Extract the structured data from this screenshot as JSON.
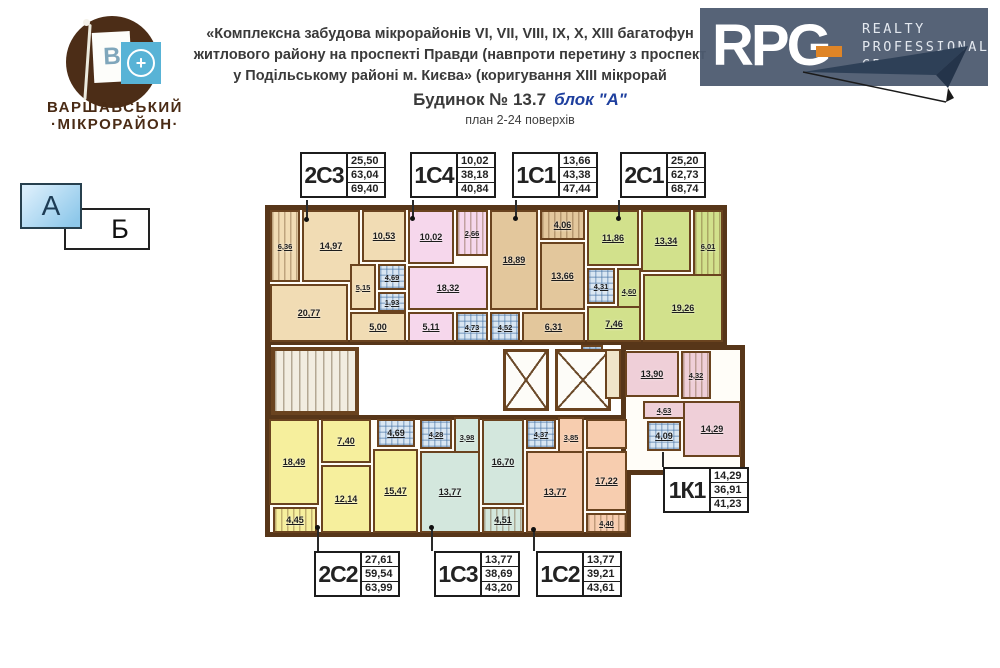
{
  "branding": {
    "microdistrict": {
      "flag_letter": "В",
      "plus": "+",
      "line1": "ВАРШАВСЬКИЙ",
      "line2": "·МІКРОРАЙОН·"
    },
    "rpg": {
      "acronym": "RPG",
      "word1": "REALTY",
      "word2": "PROFESSIONAL",
      "word3": "GROUP",
      "bg": "#4d5b70",
      "accent": "#df8527"
    }
  },
  "title": {
    "line1": "«Комплексна забудова мікрорайонів VI, VII, VIII, IX, X, XIII багатофун",
    "line2": "житлового району на проспекті Правди (навпроти перетину з проспект",
    "line3": "у Подільському районі м. Києва» (коригування XIII мікрорай",
    "building": "Будинок № 13.7",
    "block": "блок \"А\"",
    "block_color": "#1e3f9e",
    "plan_note": "план 2-24 поверхів"
  },
  "block_selector": {
    "a": "А",
    "b": "Б"
  },
  "apartment_labels": [
    {
      "code": "2С3",
      "values": [
        "25,50",
        "63,04",
        "69,40"
      ],
      "x": 300,
      "y": 152
    },
    {
      "code": "1С4",
      "values": [
        "10,02",
        "38,18",
        "40,84"
      ],
      "x": 410,
      "y": 152
    },
    {
      "code": "1С1",
      "values": [
        "13,66",
        "43,38",
        "47,44"
      ],
      "x": 512,
      "y": 152
    },
    {
      "code": "2С1",
      "values": [
        "25,20",
        "62,73",
        "68,74"
      ],
      "x": 620,
      "y": 152
    },
    {
      "code": "2С2",
      "values": [
        "27,61",
        "59,54",
        "63,99"
      ],
      "x": 314,
      "y": 551
    },
    {
      "code": "1С3",
      "values": [
        "13,77",
        "38,69",
        "43,20"
      ],
      "x": 434,
      "y": 551
    },
    {
      "code": "1С2",
      "values": [
        "13,77",
        "39,21",
        "43,61"
      ],
      "x": 536,
      "y": 551
    },
    {
      "code": "1К1",
      "values": [
        "14,29",
        "36,91",
        "41,23"
      ],
      "x": 663,
      "y": 467
    }
  ],
  "leader_lines": [
    {
      "x": 306,
      "y": 200,
      "h": 20,
      "dot": "bottom"
    },
    {
      "x": 412,
      "y": 200,
      "h": 19,
      "dot": "bottom"
    },
    {
      "x": 515,
      "y": 200,
      "h": 19,
      "dot": "bottom"
    },
    {
      "x": 618,
      "y": 200,
      "h": 19,
      "dot": "bottom"
    },
    {
      "x": 317,
      "y": 527,
      "h": 24,
      "dot": "top"
    },
    {
      "x": 431,
      "y": 527,
      "h": 24,
      "dot": "top"
    },
    {
      "x": 533,
      "y": 529,
      "h": 22,
      "dot": "top"
    },
    {
      "x": 662,
      "y": 452,
      "h": 15,
      "dot": "none"
    }
  ],
  "plan": {
    "wall_color": "#573619",
    "apt_colors": {
      "2С3": "#f1dcb4",
      "1С4": "#f6d7ec",
      "1С1": "#e3c79c",
      "2С1": "#d2e18c",
      "1К1": "#efcfd8",
      "2С2": "#f6ef9d",
      "1С3": "#d3e7dd",
      "1С2": "#f7cdaf",
      "util": "#f0e4c9"
    },
    "blocks": [
      {
        "x": 2,
        "y": 2,
        "w": 462,
        "h": 140
      },
      {
        "x": 2,
        "y": 212,
        "w": 366,
        "h": 122
      },
      {
        "x": 358,
        "y": 142,
        "w": 124,
        "h": 130
      }
    ],
    "walls": [
      {
        "x": 2,
        "y": 142,
        "w": 6,
        "h": 72
      }
    ],
    "rooms": [
      {
        "apt": "2С3",
        "a": "6,36",
        "x": 7,
        "y": 7,
        "w": 30,
        "h": 72,
        "p": "s"
      },
      {
        "apt": "2С3",
        "a": "14,97",
        "x": 39,
        "y": 7,
        "w": 58,
        "h": 72
      },
      {
        "apt": "2С3",
        "a": "10,53",
        "x": 99,
        "y": 7,
        "w": 44,
        "h": 52
      },
      {
        "apt": "2С3",
        "a": "20,77",
        "x": 7,
        "y": 81,
        "w": 78,
        "h": 58
      },
      {
        "apt": "2С3",
        "a": "5,15",
        "x": 87,
        "y": 61,
        "w": 26,
        "h": 46
      },
      {
        "apt": "2С3",
        "a": "4,69",
        "x": 115,
        "y": 61,
        "w": 28,
        "h": 26,
        "p": "b"
      },
      {
        "apt": "2С3",
        "a": "1,93",
        "x": 115,
        "y": 89,
        "w": 28,
        "h": 20,
        "p": "b"
      },
      {
        "apt": "2С3",
        "a": "5,00",
        "x": 87,
        "y": 109,
        "w": 56,
        "h": 30
      },
      {
        "apt": "1С4",
        "a": "10,02",
        "x": 145,
        "y": 7,
        "w": 46,
        "h": 54
      },
      {
        "apt": "1С4",
        "a": "2,66",
        "x": 193,
        "y": 7,
        "w": 32,
        "h": 46,
        "p": "s"
      },
      {
        "apt": "1С4",
        "a": "18,32",
        "x": 145,
        "y": 63,
        "w": 80,
        "h": 44
      },
      {
        "apt": "1С4",
        "a": "5,11",
        "x": 145,
        "y": 109,
        "w": 46,
        "h": 30
      },
      {
        "apt": "1С4",
        "a": "4,73",
        "x": 193,
        "y": 109,
        "w": 32,
        "h": 30,
        "p": "b"
      },
      {
        "apt": "1С1",
        "a": "18,89",
        "x": 227,
        "y": 7,
        "w": 48,
        "h": 100
      },
      {
        "apt": "1С1",
        "a": "4,06",
        "x": 277,
        "y": 7,
        "w": 45,
        "h": 30,
        "p": "s"
      },
      {
        "apt": "1С1",
        "a": "13,66",
        "x": 277,
        "y": 39,
        "w": 45,
        "h": 68
      },
      {
        "apt": "1С1",
        "a": "4,52",
        "x": 227,
        "y": 109,
        "w": 30,
        "h": 30,
        "p": "b"
      },
      {
        "apt": "1С1",
        "a": "6,31",
        "x": 259,
        "y": 109,
        "w": 63,
        "h": 30
      },
      {
        "apt": "2С1",
        "a": "11,86",
        "x": 324,
        "y": 7,
        "w": 52,
        "h": 56
      },
      {
        "apt": "2С1",
        "a": "13,34",
        "x": 378,
        "y": 7,
        "w": 50,
        "h": 62
      },
      {
        "apt": "2С1",
        "a": "6,01",
        "x": 430,
        "y": 7,
        "w": 30,
        "h": 72,
        "p": "s"
      },
      {
        "apt": "2С1",
        "a": "4,31",
        "x": 324,
        "y": 65,
        "w": 28,
        "h": 36,
        "p": "b"
      },
      {
        "apt": "2С1",
        "a": "4,60",
        "x": 354,
        "y": 65,
        "w": 24,
        "h": 46
      },
      {
        "apt": "2С1",
        "a": "7,46",
        "x": 324,
        "y": 103,
        "w": 54,
        "h": 36
      },
      {
        "apt": "2С1",
        "a": "19,26",
        "x": 380,
        "y": 71,
        "w": 80,
        "h": 68
      },
      {
        "apt": "2С1",
        "a": "1,90",
        "x": 318,
        "y": 142,
        "w": 22,
        "h": 18,
        "p": "b"
      },
      {
        "apt": "stair",
        "a": "",
        "x": 8,
        "y": 144,
        "w": 88,
        "h": 68,
        "p": "t"
      },
      {
        "apt": "lift",
        "a": "",
        "x": 240,
        "y": 146,
        "w": 46,
        "h": 62,
        "p": "e"
      },
      {
        "apt": "lift",
        "a": "",
        "x": 292,
        "y": 146,
        "w": 56,
        "h": 62,
        "p": "e"
      },
      {
        "apt": "util",
        "a": "",
        "x": 342,
        "y": 146,
        "w": 16,
        "h": 50
      },
      {
        "apt": "1К1",
        "a": "13,90",
        "x": 362,
        "y": 148,
        "w": 54,
        "h": 46
      },
      {
        "apt": "1К1",
        "a": "4,32",
        "x": 418,
        "y": 148,
        "w": 30,
        "h": 48,
        "p": "s"
      },
      {
        "apt": "1К1",
        "a": "4,63",
        "x": 380,
        "y": 198,
        "w": 42,
        "h": 18
      },
      {
        "apt": "1К1",
        "a": "4,09",
        "x": 384,
        "y": 218,
        "w": 34,
        "h": 30,
        "p": "b"
      },
      {
        "apt": "1К1",
        "a": "14,29",
        "x": 420,
        "y": 198,
        "w": 58,
        "h": 56
      },
      {
        "apt": "2С2",
        "a": "18,49",
        "x": 6,
        "y": 216,
        "w": 50,
        "h": 86
      },
      {
        "apt": "2С2",
        "a": "4,45",
        "x": 10,
        "y": 304,
        "w": 44,
        "h": 26,
        "p": "s"
      },
      {
        "apt": "2С2",
        "a": "7,40",
        "x": 58,
        "y": 216,
        "w": 50,
        "h": 44
      },
      {
        "apt": "2С2",
        "a": "12,14",
        "x": 58,
        "y": 262,
        "w": 50,
        "h": 68
      },
      {
        "apt": "2С2",
        "a": "4,69",
        "x": 114,
        "y": 216,
        "w": 38,
        "h": 28,
        "p": "b"
      },
      {
        "apt": "2С2",
        "a": "15,47",
        "x": 110,
        "y": 246,
        "w": 45,
        "h": 84
      },
      {
        "apt": "1С3",
        "a": "4,28",
        "x": 157,
        "y": 216,
        "w": 32,
        "h": 30,
        "p": "b"
      },
      {
        "apt": "1С3",
        "a": "3,98",
        "x": 191,
        "y": 214,
        "w": 26,
        "h": 40
      },
      {
        "apt": "1С3",
        "a": "13,77",
        "x": 157,
        "y": 248,
        "w": 60,
        "h": 82
      },
      {
        "apt": "1С3",
        "a": "16,70",
        "x": 219,
        "y": 216,
        "w": 42,
        "h": 86
      },
      {
        "apt": "1С3",
        "a": "4,51",
        "x": 219,
        "y": 304,
        "w": 42,
        "h": 26,
        "p": "s"
      },
      {
        "apt": "1С2",
        "a": "4,37",
        "x": 263,
        "y": 216,
        "w": 30,
        "h": 30,
        "p": "b"
      },
      {
        "apt": "1С2",
        "a": "3,85",
        "x": 295,
        "y": 214,
        "w": 26,
        "h": 40
      },
      {
        "apt": "1С2",
        "a": "",
        "x": 323,
        "y": 216,
        "w": 41,
        "h": 30
      },
      {
        "apt": "1С2",
        "a": "13,77",
        "x": 263,
        "y": 248,
        "w": 58,
        "h": 82
      },
      {
        "apt": "1С2",
        "a": "17,22",
        "x": 323,
        "y": 248,
        "w": 41,
        "h": 60
      },
      {
        "apt": "1С2",
        "a": "4,40",
        "x": 323,
        "y": 310,
        "w": 41,
        "h": 20,
        "p": "s"
      }
    ]
  }
}
